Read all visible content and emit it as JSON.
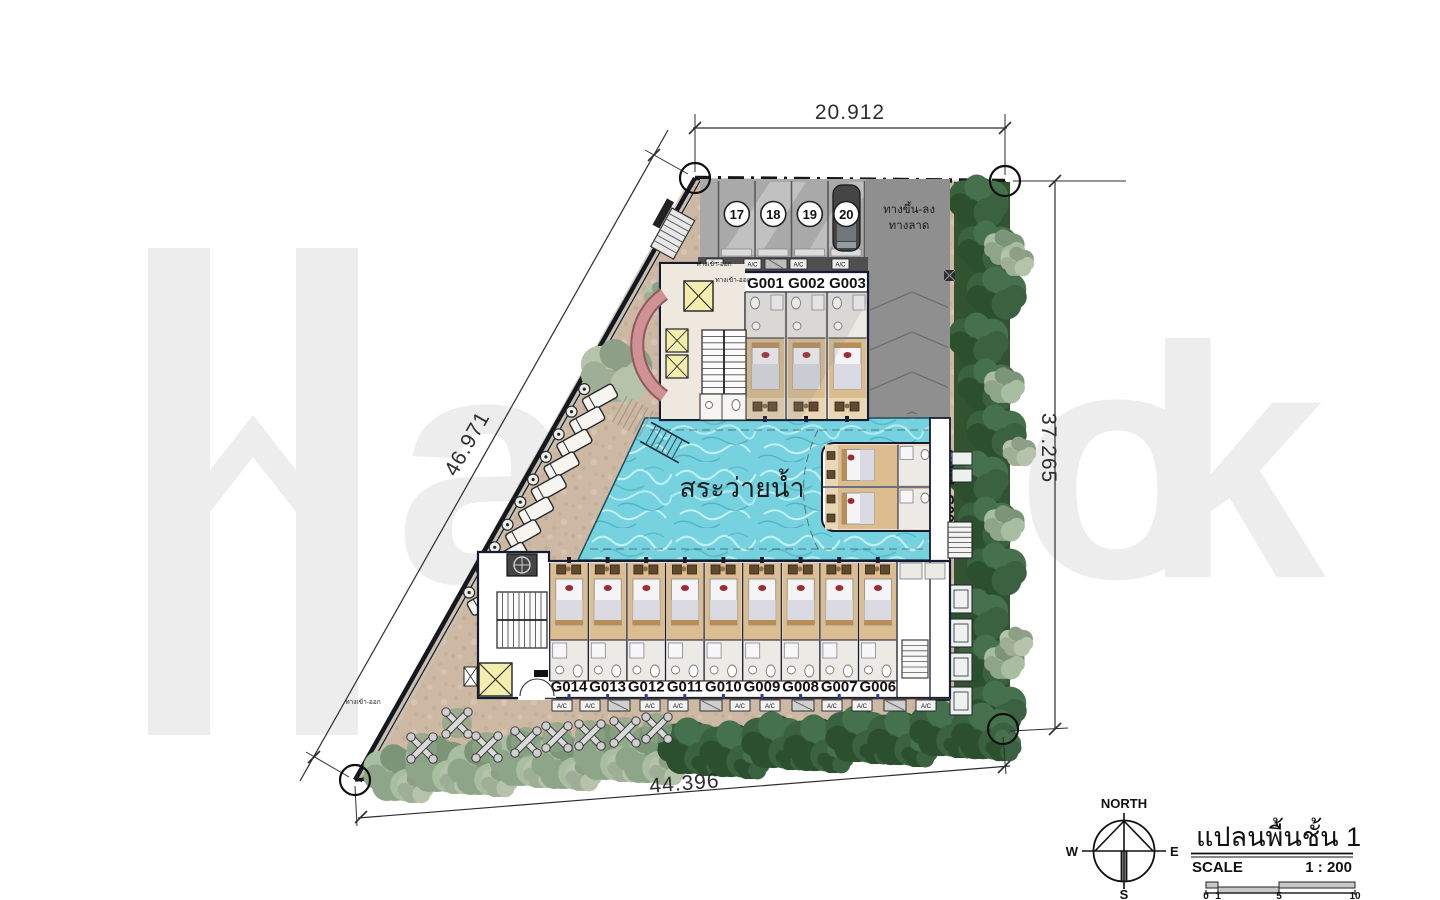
{
  "watermark": {
    "letters": [
      "H",
      "a",
      "o",
      "k"
    ]
  },
  "dimensions": {
    "top": "20.912",
    "left": "46.971",
    "right": "37.265",
    "bottom": "44.396"
  },
  "parking": {
    "stalls": [
      "17",
      "18",
      "19",
      "20"
    ],
    "ramp_line1": "ทางขึ้น-ลง",
    "ramp_line2": "ทางลาด"
  },
  "rooms": {
    "north": [
      "G001",
      "G002",
      "G003"
    ],
    "east": [
      "G004",
      "G005"
    ],
    "south": [
      "G014",
      "G013",
      "G012",
      "G011",
      "G010",
      "G009",
      "G008",
      "G007",
      "G006"
    ]
  },
  "pool": {
    "label": "สระว่ายน้ำ"
  },
  "annotations": {
    "entrance_exit": "ทางเข้า-ออก",
    "ac": "A/C"
  },
  "compass": {
    "north": "NORTH",
    "west": "W",
    "east": "E",
    "south": "S"
  },
  "titleblock": {
    "title": "แปลนพื้นชั้น 1",
    "scale_label": "SCALE",
    "scale_value": "1 : 200",
    "scalebar_ticks": [
      "0",
      "1",
      "5",
      "10"
    ]
  },
  "colors": {
    "pool": "#76d2df",
    "terrace": "#cdb8a3",
    "tree_dark": "#2f5433",
    "tree_light": "#9db398",
    "parking": "#a9a9a9",
    "drive": "#8f8f8f",
    "wall": "#161a32",
    "bed_red": "#9e2b33",
    "elevator": "#f3edae",
    "entry_arc": "#cf9193",
    "watermark": "#ededed"
  }
}
